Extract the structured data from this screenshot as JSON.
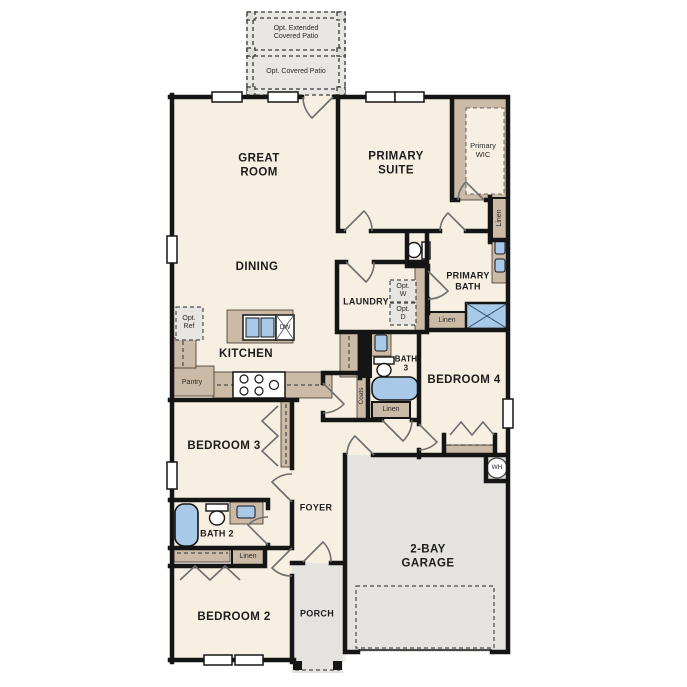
{
  "plan": {
    "patio": {
      "extended_label": "Opt. Extended\nCovered Patio",
      "covered_label": "Opt. Covered Patio"
    },
    "rooms": {
      "great_room": "GREAT\nROOM",
      "dining": "DINING",
      "kitchen": "KITCHEN",
      "primary_suite": "PRIMARY\nSUITE",
      "primary_wic": "Primary\nWIC",
      "laundry": "LAUNDRY",
      "primary_bath": "PRIMARY\nBATH",
      "bath_3": "BATH\n3",
      "bedroom_4": "BEDROOM 4",
      "bedroom_3": "BEDROOM 3",
      "foyer": "FOYER",
      "bath_2": "BATH 2",
      "bedroom_2": "BEDROOM 2",
      "porch": "PORCH",
      "garage": "2-BAY\nGARAGE"
    },
    "annotations": {
      "opt_ref": "Opt.\nRef",
      "opt_w": "Opt.\nW",
      "opt_d": "Opt.\nD",
      "pantry": "Pantry",
      "linen": "Linen",
      "coats": "Coats",
      "dishwasher": "DW",
      "water_heater": "WH"
    },
    "colors": {
      "floor": "#f7f0e2",
      "slab_gray": "#e4e3e0",
      "patio_gray": "#e8e7e4",
      "cabinet_tan": "#cbbba6",
      "fixture_blue": "#a9c9e8",
      "wall": "#151515"
    }
  }
}
